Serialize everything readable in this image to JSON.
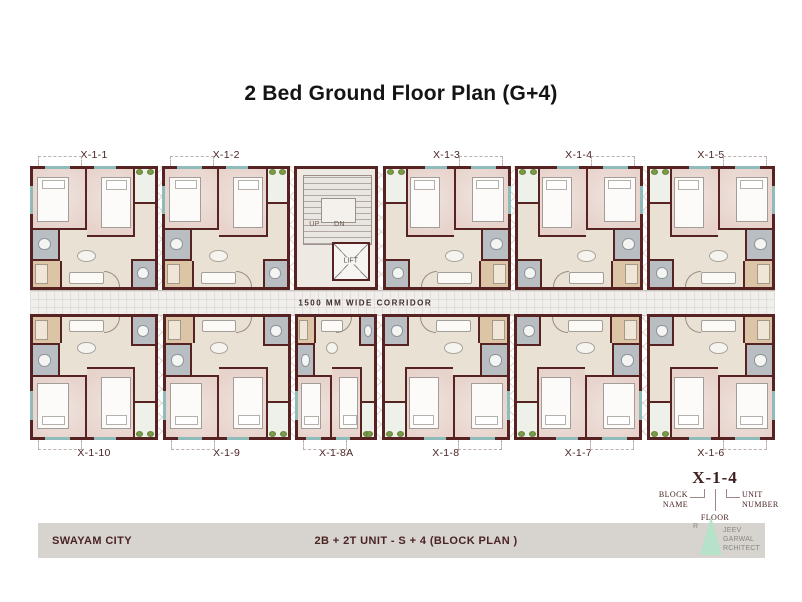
{
  "title": "2 Bed Ground Floor Plan (G+4)",
  "plan": {
    "corridor_label": "1500 MM WIDE CORRIDOR",
    "core": {
      "up": "UP",
      "dn": "DN",
      "lift": "LIFT"
    },
    "top_units": [
      {
        "id": "X-1-1"
      },
      {
        "id": "X-1-2"
      },
      {
        "id": "X-1-3"
      },
      {
        "id": "X-1-4"
      },
      {
        "id": "X-1-5"
      }
    ],
    "bottom_units": [
      {
        "id": "X-1-10"
      },
      {
        "id": "X-1-9"
      },
      {
        "id": "X-1-8A",
        "narrow": true
      },
      {
        "id": "X-1-8"
      },
      {
        "id": "X-1-7"
      },
      {
        "id": "X-1-6"
      }
    ]
  },
  "legend": {
    "example": "X-1-4",
    "block_name": "BLOCK\nNAME",
    "floor": "FLOOR",
    "unit_number": "UNIT\nNUMBER"
  },
  "footer": {
    "left": "SWAYAM CITY",
    "center": "2B + 2T  UNIT - S + 4  (BLOCK PLAN )",
    "logo": {
      "r": "R",
      "lines": [
        "JEEV",
        "GARWAL",
        "RCHITECT"
      ]
    }
  },
  "colors": {
    "wall": "#562222",
    "bedroom": "#ead9d3",
    "living": "#e9e1d3",
    "bath": "#b9bec2",
    "kitchen": "#dbc5a6",
    "corridor": "#f1efeb",
    "accent_teal": "#8fbcba",
    "plant_green": "#6f8f3e",
    "label_maroon": "#4a2424",
    "footer_bg": "#d7d3ce",
    "logo_mint": "#b6e2ca"
  }
}
